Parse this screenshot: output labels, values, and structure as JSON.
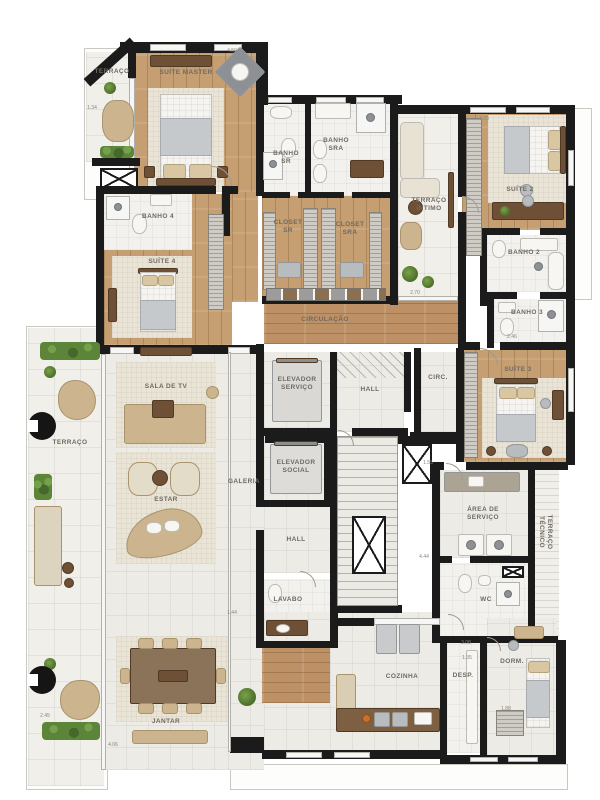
{
  "plan": {
    "width": 600,
    "height": 800,
    "background": "#ffffff"
  },
  "colors": {
    "wall": "#1b1b1b",
    "wood_floor": "#c59e71",
    "corridor_wood": "#bd9165",
    "tile": "#edebe5",
    "carpet": "#e9e4d5",
    "furniture_tan": "#ccb58e",
    "furniture_dark_wood": "#6d5036",
    "plant_green": "#5d8539",
    "label_text": "#6f6a62"
  },
  "rooms": [
    {
      "id": "terraco-master",
      "name": "TERRAÇO",
      "x": 112,
      "y": 72
    },
    {
      "id": "suite-master",
      "name": "SUÍTE MASTER",
      "x": 186,
      "y": 73
    },
    {
      "id": "banho-sr",
      "name": "BANHO\nSR",
      "x": 286,
      "y": 158
    },
    {
      "id": "banho-sra",
      "name": "BANHO\nSRA",
      "x": 336,
      "y": 145
    },
    {
      "id": "closet-sr",
      "name": "CLOSET\nSR",
      "x": 288,
      "y": 227
    },
    {
      "id": "closet-sra",
      "name": "CLOSET\nSRA",
      "x": 350,
      "y": 229
    },
    {
      "id": "terraco-intimo",
      "name": "TERRAÇO\nÍNTIMO",
      "x": 429,
      "y": 205
    },
    {
      "id": "suite-2",
      "name": "SUÍTE 2",
      "x": 520,
      "y": 190
    },
    {
      "id": "banho-2",
      "name": "BANHO 2",
      "x": 524,
      "y": 253
    },
    {
      "id": "banho-3",
      "name": "BANHO 3",
      "x": 527,
      "y": 313
    },
    {
      "id": "suite-3",
      "name": "SUÍTE 3",
      "x": 518,
      "y": 370
    },
    {
      "id": "banho-4",
      "name": "BANHO 4",
      "x": 158,
      "y": 217
    },
    {
      "id": "suite-4",
      "name": "SUÍTE 4",
      "x": 162,
      "y": 262
    },
    {
      "id": "circulacao",
      "name": "CIRCULAÇÃO",
      "x": 325,
      "y": 320
    },
    {
      "id": "elevador-servico",
      "name": "ELEVADOR\nSERVIÇO",
      "x": 297,
      "y": 384
    },
    {
      "id": "hall-superior",
      "name": "HALL",
      "x": 370,
      "y": 390
    },
    {
      "id": "circ",
      "name": "CIRC.",
      "x": 438,
      "y": 378
    },
    {
      "id": "elevador-social",
      "name": "ELEVADOR\nSOCIAL",
      "x": 296,
      "y": 467
    },
    {
      "id": "hall-inferior",
      "name": "HALL",
      "x": 296,
      "y": 540
    },
    {
      "id": "lavabo",
      "name": "LAVABO",
      "x": 288,
      "y": 600
    },
    {
      "id": "sala-de-tv",
      "name": "SALA DE TV",
      "x": 166,
      "y": 387
    },
    {
      "id": "estar",
      "name": "ESTAR",
      "x": 166,
      "y": 500
    },
    {
      "id": "galeria",
      "name": "GALERIA",
      "x": 244,
      "y": 482
    },
    {
      "id": "terraco-lateral",
      "name": "TERRAÇO",
      "x": 70,
      "y": 443
    },
    {
      "id": "jantar",
      "name": "JANTAR",
      "x": 166,
      "y": 722
    },
    {
      "id": "cozinha",
      "name": "COZINHA",
      "x": 402,
      "y": 677
    },
    {
      "id": "despensa",
      "name": "DESP.",
      "x": 463,
      "y": 676
    },
    {
      "id": "dormitorio",
      "name": "DORM.",
      "x": 512,
      "y": 662
    },
    {
      "id": "area-de-servico",
      "name": "ÁREA DE\nSERVIÇO",
      "x": 483,
      "y": 514
    },
    {
      "id": "wc",
      "name": "WC",
      "x": 486,
      "y": 600
    },
    {
      "id": "terraco-tecnico",
      "name": "TERRAÇO\nTÉCNICO",
      "x": 545,
      "y": 532,
      "rot": 90
    }
  ],
  "dimensions": [
    {
      "text": "4.50",
      "x": 232,
      "y": 51
    },
    {
      "text": "4.20",
      "x": 484,
      "y": 119
    },
    {
      "text": "1.34",
      "x": 92,
      "y": 108
    },
    {
      "text": "2.70",
      "x": 415,
      "y": 293
    },
    {
      "text": "2.46",
      "x": 512,
      "y": 337
    },
    {
      "text": "1.55",
      "x": 428,
      "y": 463
    },
    {
      "text": "4.44",
      "x": 424,
      "y": 557
    },
    {
      "text": "3.08",
      "x": 466,
      "y": 643
    },
    {
      "text": "1.35",
      "x": 467,
      "y": 658
    },
    {
      "text": "1.88",
      "x": 506,
      "y": 709
    },
    {
      "text": "1.44",
      "x": 232,
      "y": 613
    },
    {
      "text": "4.06",
      "x": 113,
      "y": 745
    },
    {
      "text": "2.45",
      "x": 45,
      "y": 716
    }
  ]
}
